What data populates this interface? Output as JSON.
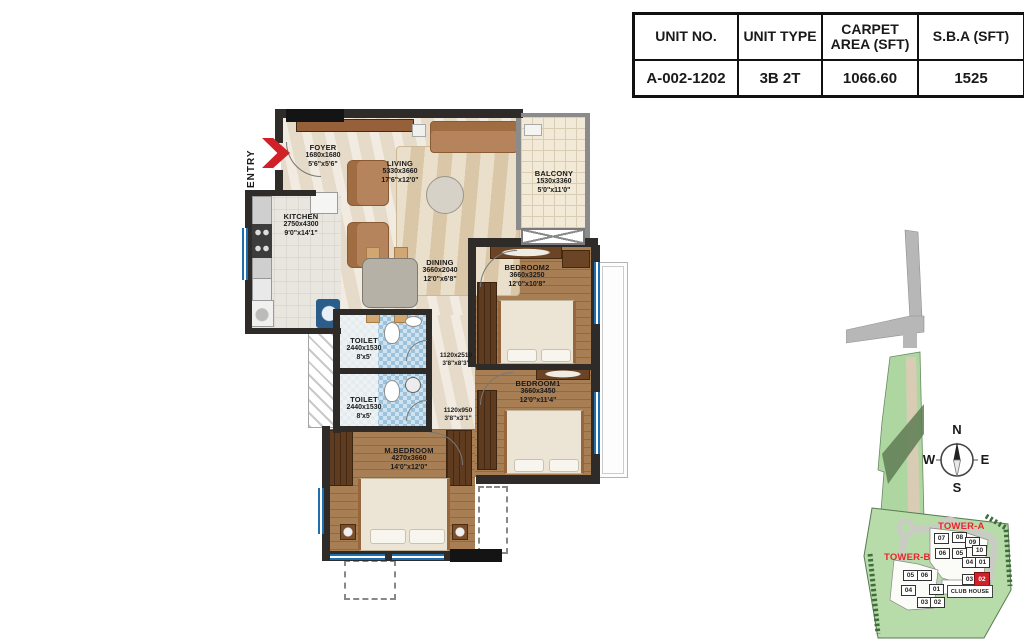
{
  "unit_table": {
    "headers": [
      "UNIT NO.",
      "UNIT TYPE",
      "CARPET AREA (SFT)",
      "S.B.A (SFT)"
    ],
    "values": [
      "A-002-1202",
      "3B 2T",
      "1066.60",
      "1525"
    ]
  },
  "floorplan": {
    "entry_label": "ENTRY",
    "rooms": [
      {
        "name": "FOYER",
        "mm": "1680x1680",
        "ft": "5'6\"x5'6\""
      },
      {
        "name": "LIVING",
        "mm": "5330x3660",
        "ft": "17'6\"x12'0\""
      },
      {
        "name": "BALCONY",
        "mm": "1530x3360",
        "ft": "5'0\"x11'0\""
      },
      {
        "name": "KITCHEN",
        "mm": "2750x4300",
        "ft": "9'0\"x14'1\""
      },
      {
        "name": "DINING",
        "mm": "3660x2040",
        "ft": "12'0\"x6'8\""
      },
      {
        "name": "BEDROOM2",
        "mm": "3660x3250",
        "ft": "12'0\"x10'8\""
      },
      {
        "name": "TOILET",
        "mm": "2440x1530",
        "ft": "8'x5'"
      },
      {
        "name": "TOILET",
        "mm": "2440x1530",
        "ft": "8'x5'"
      },
      {
        "name": "BEDROOM1",
        "mm": "3660x3450",
        "ft": "12'0\"x11'4\""
      },
      {
        "name": "M.BEDROOM",
        "mm": "4270x3660",
        "ft": "14'0\"x12'0\""
      }
    ],
    "passages": [
      {
        "mm": "1120x2510",
        "ft": "3'8\"x8'3\""
      },
      {
        "mm": "1120x950",
        "ft": "3'8\"x3'1\""
      }
    ]
  },
  "sitemap": {
    "tower_a_label": "TOWER-A",
    "tower_b_label": "TOWER-B",
    "club_house_label": "CLUB HOUSE",
    "highlighted_unit": "02",
    "tower_a_units": [
      "07",
      "08",
      "09",
      "10",
      "06",
      "05",
      "04",
      "01",
      "03",
      "02"
    ],
    "tower_b_units": [
      "05",
      "06",
      "04",
      "01",
      "03",
      "02"
    ],
    "compass": {
      "n": "N",
      "e": "E",
      "s": "S",
      "w": "W"
    }
  },
  "colors": {
    "entry_arrow": "#cf2127",
    "tower_label": "#e8252b",
    "highlight_unit": "#cf2127",
    "site_green": "#b7dcaa",
    "wood_floor": "#a87e55",
    "marble_floor": "#ebe1d1",
    "toilet_blue": "#a9c9e0"
  }
}
